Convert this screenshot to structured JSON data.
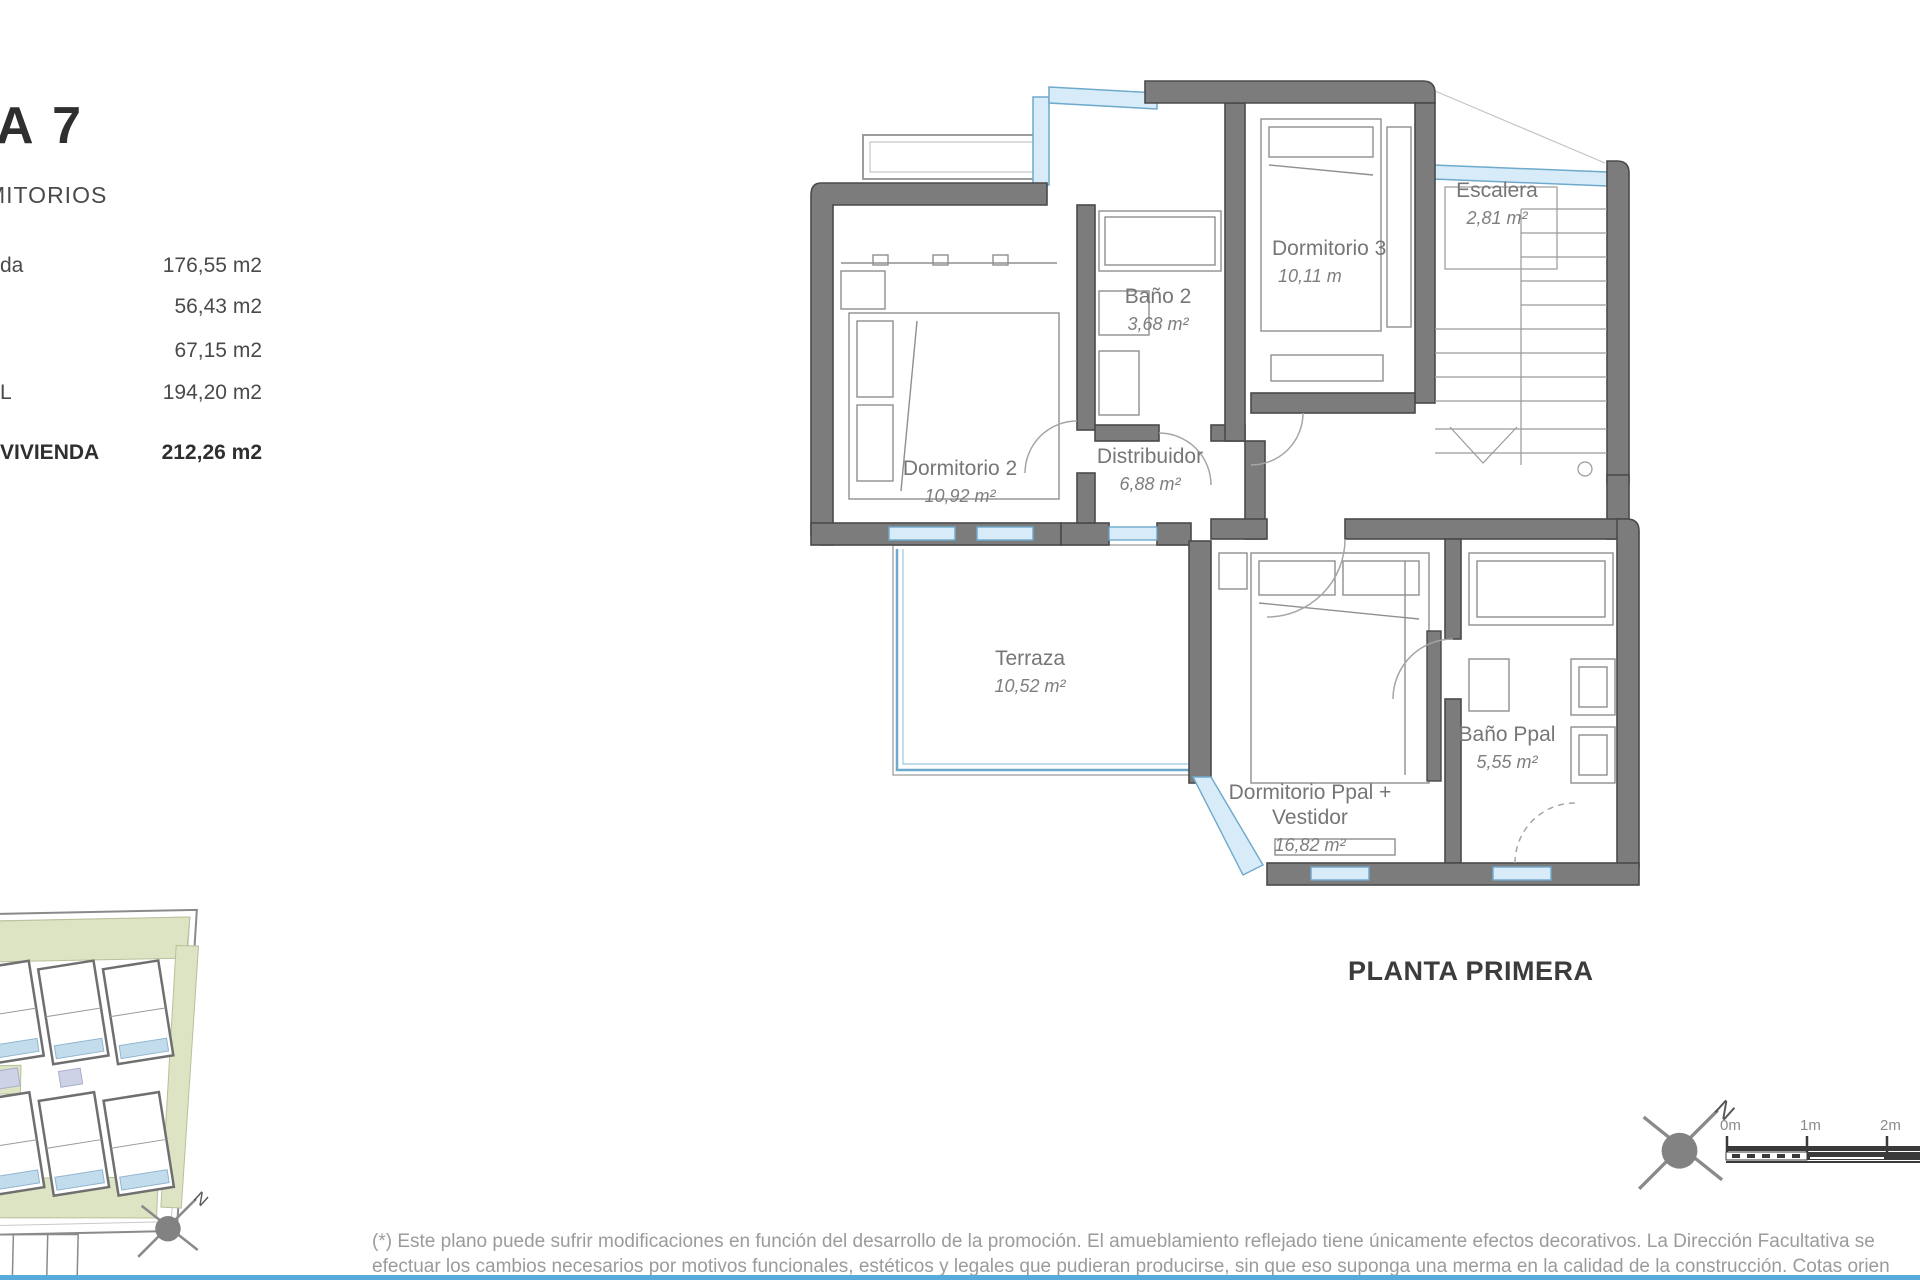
{
  "summary_panel": {
    "title_fragment": "A 7",
    "subtitle_fragment": "MITORIOS",
    "rows": [
      {
        "label": "da",
        "value": "176,55 m2"
      },
      {
        "label": "",
        "value": "56,43 m2"
      },
      {
        "label": "",
        "value": "67,15 m2"
      },
      {
        "label": "L",
        "value": "194,20 m2"
      },
      {
        "label": "VIVIENDA",
        "value": "212,26 m2"
      }
    ]
  },
  "plan": {
    "caption": "PLANTA PRIMERA",
    "rooms": [
      {
        "id": "dormitorio-2",
        "name": "Dormitorio 2",
        "area": "10,92 m²"
      },
      {
        "id": "bano-2",
        "name": "Baño 2",
        "area": "3,68 m²"
      },
      {
        "id": "dormitorio-3",
        "name": "Dormitorio 3",
        "area": "10,11 m"
      },
      {
        "id": "escalera",
        "name": "Escalera",
        "area": "2,81 m²"
      },
      {
        "id": "distribuidor",
        "name": "Distribuidor",
        "area": "6,88 m²"
      },
      {
        "id": "terraza",
        "name": "Terraza",
        "area": "10,52 m²"
      },
      {
        "id": "dormitorio-ppal",
        "name": "Dormitorio Ppal + Vestidor",
        "area": "16,82 m²"
      },
      {
        "id": "bano-ppal",
        "name": "Baño Ppal",
        "area": "5,55 m²"
      }
    ],
    "colors": {
      "wall": "#7c7c7c",
      "wall_outline": "#4a4a4a",
      "window_fill": "#d7ecf8",
      "window_stroke": "#6fa9cc",
      "furniture_line": "#8f8f8f",
      "label_text": "#767676"
    }
  },
  "compass": {
    "letter": "N"
  },
  "scale_bar": {
    "labels": [
      "0m",
      "1m",
      "2m"
    ]
  },
  "site_plan_colors": {
    "green": "#dde4c4",
    "pool": "#c3dcec",
    "lavender": "#cdd2e6"
  },
  "footer": {
    "line1": "(*) Este plano puede sufrir modificaciones en función del desarrollo de la promoción. El amueblamiento reflejado tiene únicamente efectos decorativos. La Dirección Facultativa se",
    "line2": "efectuar los cambios necesarios por motivos funcionales, estéticos y legales que pudieran producirse, sin que eso suponga una merma en la calidad de la construcción. Cotas orien"
  }
}
